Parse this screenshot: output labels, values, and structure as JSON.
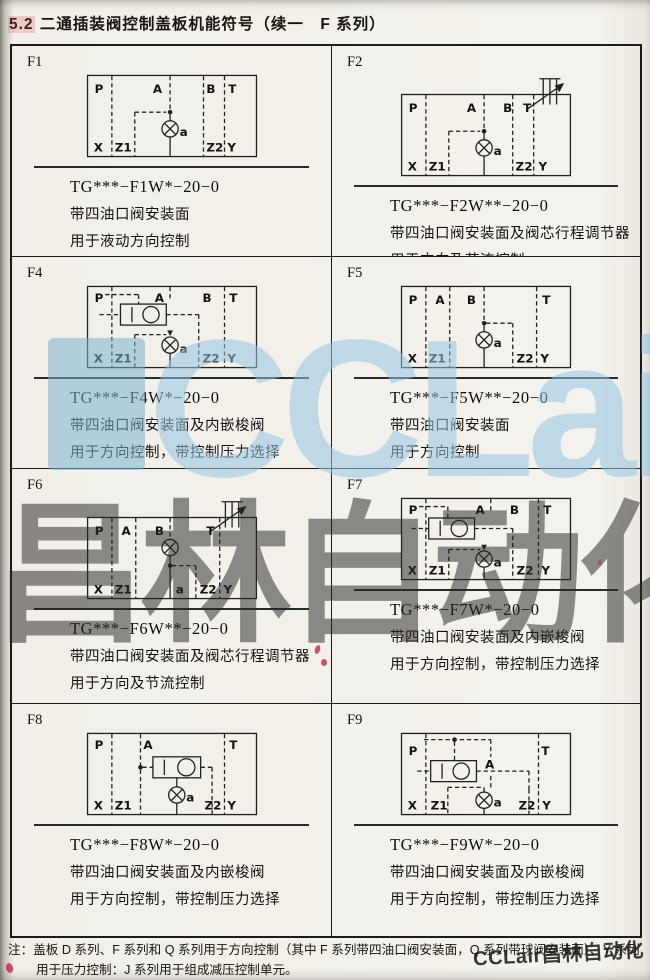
{
  "title": {
    "section": "5.2",
    "text": "二通插装阀控制盖板机能符号（续一　F 系列）"
  },
  "ports": {
    "p": "P",
    "a": "A",
    "b": "B",
    "t": "T",
    "x": "X",
    "z1": "Z1",
    "valve": "a",
    "z2": "Z2",
    "y": "Y"
  },
  "cells": [
    {
      "id": "F1",
      "code": "TG***−F1W*−20−0",
      "desc1": "带四油口阀安装面",
      "desc2": "用于液动方向控制"
    },
    {
      "id": "F2",
      "code": "TG***−F2W**−20−0",
      "desc1": "带四油口阀安装面及阀芯行程调节器",
      "desc2": "用于方向及节流控制"
    },
    {
      "id": "F4",
      "code": "TG***−F4W*−20−0",
      "desc1": "带四油口阀安装面及内嵌梭阀",
      "desc2": "用于方向控制，带控制压力选择"
    },
    {
      "id": "F5",
      "code": "TG***−F5W**−20−0",
      "desc1": "带四油口阀安装面",
      "desc2": "用于方向控制"
    },
    {
      "id": "F6",
      "code": "TG***−F6W**−20−0",
      "desc1": "带四油口阀安装面及阀芯行程调节器",
      "desc2": "用于方向及节流控制"
    },
    {
      "id": "F7",
      "code": "TG***−F7W*−20−0",
      "desc1": "带四油口阀安装面及内嵌梭阀",
      "desc2": "用于方向控制，带控制压力选择"
    },
    {
      "id": "F8",
      "code": "TG***−F8W*−20−0",
      "desc1": "带四油口阀安装面及内嵌梭阀",
      "desc2": "用于方向控制，带控制压力选择"
    },
    {
      "id": "F9",
      "code": "TG***−F9W*−20−0",
      "desc1": "带四油口阀安装面及内嵌梭阀",
      "desc2": "用于方向控制，带控制压力选择"
    }
  ],
  "note": {
    "label": "注：",
    "line1": "盖板 D 系列、F 系列和 Q 系列用于方向控制（其中 F 系列带四油口阀安装面，Q 系列带球阀安装面）、Y 系列",
    "line2": "用于压力控制：J 系列用于组成减压控制单元。"
  },
  "watermarks": {
    "blue_text": "CCLair",
    "gray_text": "昌林自动化",
    "bottom_text": "CCLair昌林自动化"
  },
  "colors": {
    "paper": "#f2efe9",
    "ink": "#1b1b1b",
    "watermark_blue": "#94c4e2",
    "watermark_gray": "#2a2826",
    "pen_red": "#c62442"
  }
}
